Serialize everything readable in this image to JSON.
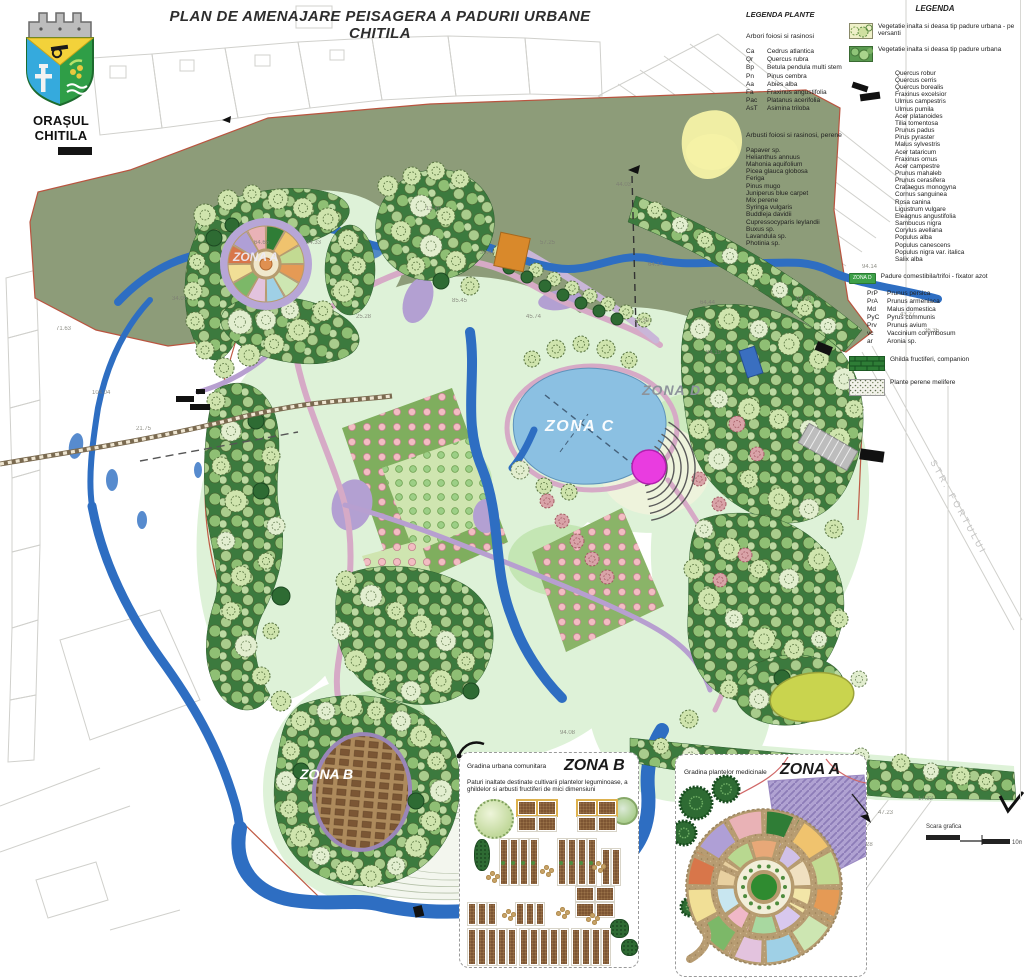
{
  "header": {
    "title": "PLAN DE AMENAJARE PEISAGERA A PADURII URBANE CHITILA",
    "logo_caption": "ORAȘUL CHITILA"
  },
  "legend_plante": {
    "title": "LEGENDA PLANTE",
    "section1_title": "Arbori foiosi si rasinosi",
    "trees": [
      {
        "code": "Ca",
        "name": "Cedrus atlantica"
      },
      {
        "code": "Qr",
        "name": "Quercus rubra"
      },
      {
        "code": "Bp",
        "name": "Betula pendula multi stem"
      },
      {
        "code": "Pn",
        "name": "Pinus cembra"
      },
      {
        "code": "Aa",
        "name": "Abies alba"
      },
      {
        "code": "Fa",
        "name": "Fraxinus angustifolia"
      },
      {
        "code": "Pac",
        "name": "Platanus acerifolia"
      },
      {
        "code": "AsT",
        "name": "Asimina triloba"
      }
    ],
    "section2_title": "Arbusti foiosi si rasinosi, perene",
    "shrubs": [
      "Papaver sp.",
      "Helianthus annuus",
      "Mahonia aquifolium",
      "Picea glauca globosa",
      "Feriga",
      "Pinus mugo",
      "Juniperus blue carpet",
      "Mix perene",
      "Syringa vulgaris",
      "Buddleja davidii",
      "Cupressocyparis leylandii",
      "Buxus sp.",
      "Lavandula sp.",
      "Photinia sp."
    ]
  },
  "legend": {
    "title": "LEGENDA",
    "entry1": "Vegetatie inalta si deasa tip padure urbana - pe versanti",
    "entry2": "Vegetatie inalta si deasa tip padure urbana",
    "species": [
      "Quercus robur",
      "Quercus cerris",
      "Quercus borealis",
      "Fraxinus excelsior",
      "Ulmus campestris",
      "Ulmus pumila",
      "Acer platanoides",
      "Tilia tomentosa",
      "Prunus padus",
      "Pirus pyraster",
      "Malus sylvestris",
      "Acer tataricum",
      "Fraxinus ornus",
      "Acer campestre",
      "Prunus mahaleb",
      "Prunus cerasifera",
      "Crataegus monogyna",
      "Cornus sanguinea",
      "Rosa canina",
      "Ligustrum vulgare",
      "Eleagnus angustifolia",
      "Sambucus nigra",
      "Corylus avellana",
      "Populus alba",
      "Populus canescens",
      "Populus nigra var. italica",
      "Salix alba"
    ],
    "zona_d_badge": "ZONA D",
    "zona_d_label": "Padure comestibila/trifoi - fixator azot",
    "food_forest": [
      {
        "code": "PrP",
        "name": "Prunus persica"
      },
      {
        "code": "PrA",
        "name": "Prunus armeniaca"
      },
      {
        "code": "Md",
        "name": "Malus domestica"
      },
      {
        "code": "PyC",
        "name": "Pyrus communis"
      },
      {
        "code": "Prv",
        "name": "Prunus avium"
      },
      {
        "code": "vc",
        "name": "Vaccinium corymbosum"
      },
      {
        "code": "ar",
        "name": "Aronia sp."
      }
    ],
    "entry3": "Ghilda fructiferi, companion",
    "entry4": "Plante perene melifere"
  },
  "map": {
    "street_label": "STR. FORTULUI",
    "zones": [
      {
        "key": "a",
        "text": "ZONA A",
        "x": 233,
        "y": 250,
        "cls": "zl-a"
      },
      {
        "key": "b",
        "text": "ZONA B",
        "x": 300,
        "y": 766,
        "cls": "zl-b"
      },
      {
        "key": "c",
        "text": "ZONA C",
        "x": 545,
        "y": 418,
        "cls": "zl-c"
      },
      {
        "key": "d",
        "text": "ZONA D",
        "x": 642,
        "y": 382,
        "cls": "zl-d"
      }
    ],
    "dims": [
      {
        "t": "44.03",
        "x": 616,
        "y": 182
      },
      {
        "t": "64.14",
        "x": 648,
        "y": 262
      },
      {
        "t": "14.30",
        "x": 634,
        "y": 318
      },
      {
        "t": "94.19",
        "x": 706,
        "y": 350
      },
      {
        "t": "34.05",
        "x": 172,
        "y": 296
      },
      {
        "t": "25.28",
        "x": 356,
        "y": 314
      },
      {
        "t": "85.45",
        "x": 452,
        "y": 298
      },
      {
        "t": "43.27",
        "x": 900,
        "y": 312
      },
      {
        "t": "36.35",
        "x": 924,
        "y": 328
      },
      {
        "t": "104.04",
        "x": 92,
        "y": 390
      },
      {
        "t": "64.65",
        "x": 254,
        "y": 240
      },
      {
        "t": "45.74",
        "x": 526,
        "y": 314
      },
      {
        "t": "84.08",
        "x": 796,
        "y": 296
      },
      {
        "t": "94.14",
        "x": 862,
        "y": 264
      },
      {
        "t": "71.63",
        "x": 56,
        "y": 326
      },
      {
        "t": "21.75",
        "x": 136,
        "y": 426
      },
      {
        "t": "13.40",
        "x": 426,
        "y": 206
      },
      {
        "t": "57.25",
        "x": 540,
        "y": 240
      },
      {
        "t": "47.23",
        "x": 878,
        "y": 810
      },
      {
        "t": "34.33",
        "x": 306,
        "y": 240
      },
      {
        "t": "17.32",
        "x": 918,
        "y": 796
      },
      {
        "t": "28",
        "x": 866,
        "y": 842
      },
      {
        "t": "94.08",
        "x": 560,
        "y": 730
      },
      {
        "t": "64.44",
        "x": 700,
        "y": 300
      },
      {
        "t": "34.44",
        "x": 480,
        "y": 250
      }
    ]
  },
  "inset_b": {
    "label": "Gradina urbana comunitara",
    "title": "ZONA B",
    "description": "Paturi inaltate destinate cultivarii plantelor leguminoase, a ghildelor si arbusti fructiferi de mici dimensiuni"
  },
  "inset_a": {
    "label": "Gradina plantelor medicinale",
    "title": "ZONA A"
  },
  "scale_bar": {
    "label": "Scara grafica",
    "length_label": "10m"
  }
}
